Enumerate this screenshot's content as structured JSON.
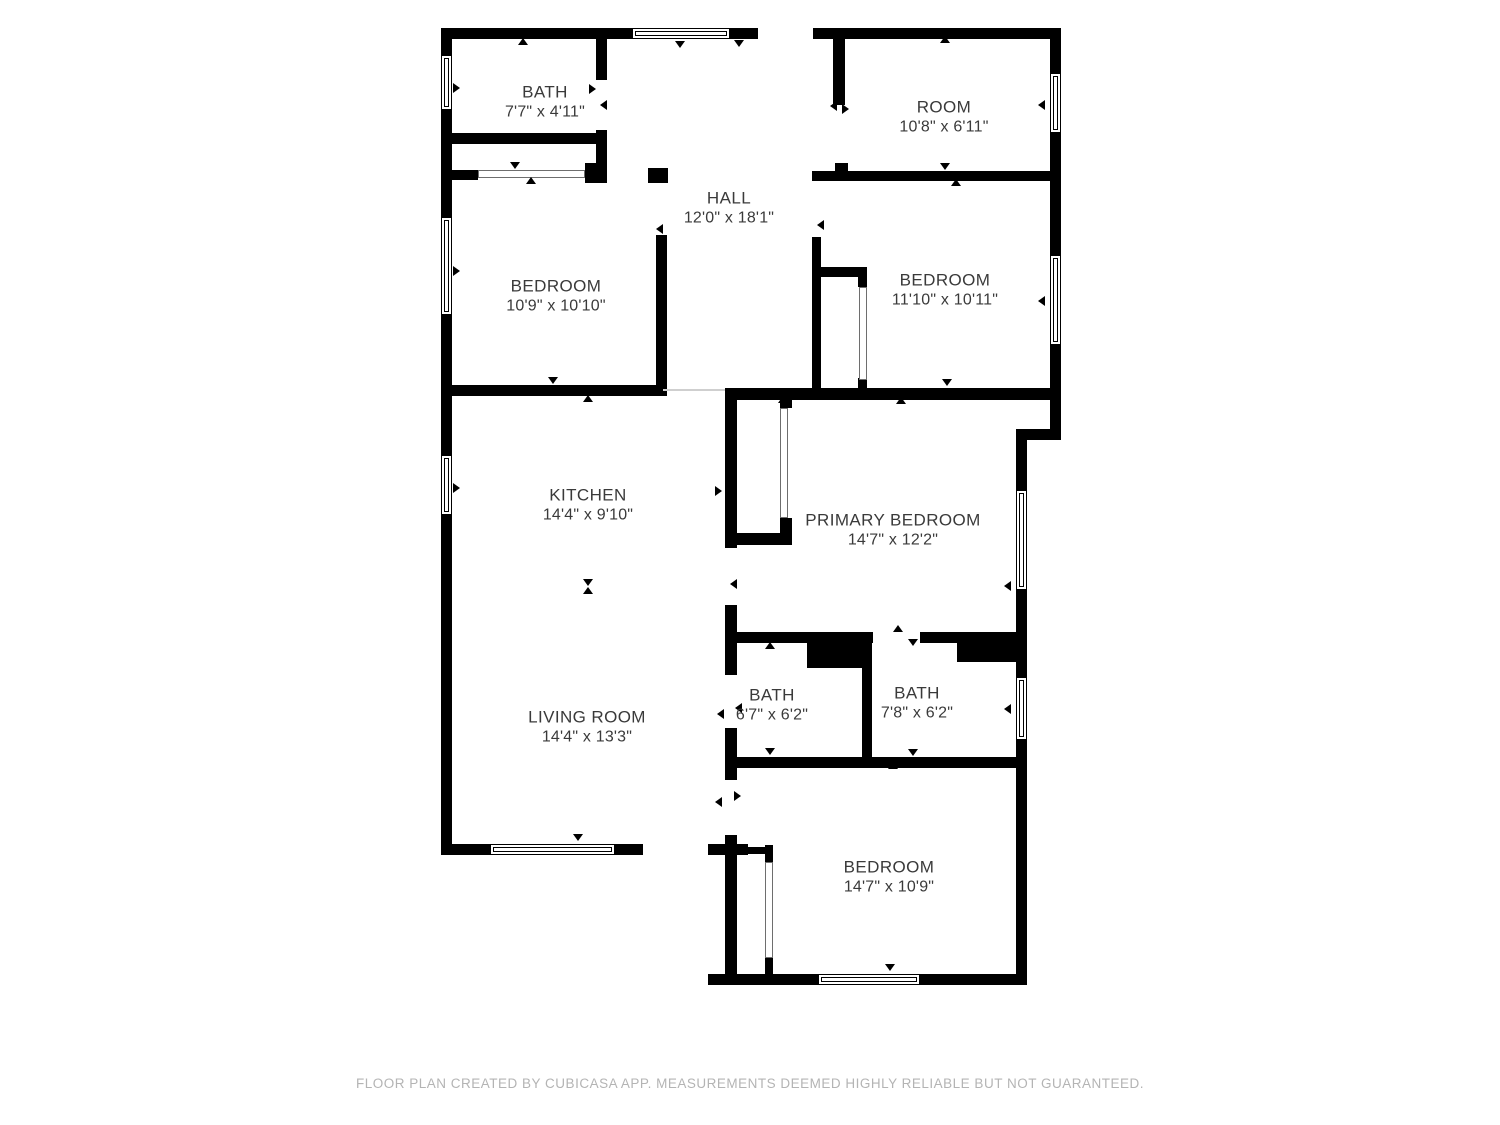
{
  "page": {
    "background": "#ffffff"
  },
  "footer": {
    "text": "FLOOR PLAN CREATED BY CUBICASA APP. MEASUREMENTS DEEMED HIGHLY RELIABLE BUT NOT GUARANTEED."
  },
  "plan": {
    "wall_color": "#000000",
    "label_color": "#3a3a3a",
    "footer_color": "#b4b4b4",
    "rooms": [
      {
        "name": "BATH",
        "dims": "7'7\" x 4'11\"",
        "cx": 545,
        "cy": 102
      },
      {
        "name": "ROOM",
        "dims": "10'8\" x 6'11\"",
        "cx": 944,
        "cy": 117
      },
      {
        "name": "HALL",
        "dims": "12'0\" x 18'1\"",
        "cx": 729,
        "cy": 208
      },
      {
        "name": "BEDROOM",
        "dims": "10'9\" x 10'10\"",
        "cx": 556,
        "cy": 296
      },
      {
        "name": "BEDROOM",
        "dims": "11'10\" x 10'11\"",
        "cx": 945,
        "cy": 290
      },
      {
        "name": "KITCHEN",
        "dims": "14'4\" x 9'10\"",
        "cx": 588,
        "cy": 505
      },
      {
        "name": "PRIMARY BEDROOM",
        "dims": "14'7\" x 12'2\"",
        "cx": 893,
        "cy": 530
      },
      {
        "name": "LIVING ROOM",
        "dims": "14'4\" x 13'3\"",
        "cx": 587,
        "cy": 727
      },
      {
        "name": "BATH",
        "dims": "6'7\" x 6'2\"",
        "cx": 772,
        "cy": 705
      },
      {
        "name": "BATH",
        "dims": "7'8\" x 6'2\"",
        "cx": 917,
        "cy": 703
      },
      {
        "name": "BEDROOM",
        "dims": "14'7\" x 10'9\"",
        "cx": 889,
        "cy": 877
      }
    ],
    "walls": [
      [
        441,
        28,
        191,
        11
      ],
      [
        730,
        28,
        28,
        11
      ],
      [
        813,
        28,
        248,
        11
      ],
      [
        441,
        28,
        11,
        27
      ],
      [
        441,
        110,
        11,
        107
      ],
      [
        441,
        315,
        11,
        140
      ],
      [
        441,
        515,
        11,
        340
      ],
      [
        1050,
        28,
        11,
        45
      ],
      [
        1050,
        133,
        11,
        122
      ],
      [
        1050,
        345,
        11,
        95
      ],
      [
        1016,
        429,
        45,
        11
      ],
      [
        1016,
        440,
        11,
        50
      ],
      [
        1016,
        590,
        11,
        87
      ],
      [
        1016,
        740,
        11,
        234
      ],
      [
        441,
        844,
        49,
        11
      ],
      [
        615,
        844,
        28,
        11
      ],
      [
        708,
        844,
        40,
        11
      ],
      [
        708,
        974,
        110,
        11
      ],
      [
        920,
        974,
        107,
        11
      ],
      [
        441,
        133,
        166,
        11
      ],
      [
        441,
        170,
        37,
        10
      ],
      [
        585,
        163,
        22,
        20
      ],
      [
        648,
        168,
        20,
        15
      ],
      [
        812,
        171,
        249,
        10
      ],
      [
        441,
        385,
        222,
        11
      ],
      [
        725,
        388,
        336,
        12
      ],
      [
        596,
        28,
        11,
        52
      ],
      [
        596,
        130,
        11,
        53
      ],
      [
        656,
        235,
        11,
        161
      ],
      [
        833,
        28,
        12,
        77
      ],
      [
        835,
        163,
        13,
        17
      ],
      [
        812,
        237,
        9,
        159
      ],
      [
        725,
        388,
        12,
        160
      ],
      [
        725,
        605,
        12,
        70
      ],
      [
        725,
        728,
        12,
        52
      ],
      [
        725,
        835,
        12,
        150
      ],
      [
        862,
        640,
        10,
        128
      ],
      [
        733,
        632,
        140,
        11
      ],
      [
        920,
        632,
        37,
        11
      ],
      [
        733,
        757,
        284,
        11
      ],
      [
        807,
        632,
        63,
        36
      ],
      [
        957,
        632,
        60,
        30
      ],
      [
        780,
        395,
        12,
        13
      ],
      [
        780,
        518,
        12,
        27
      ],
      [
        737,
        533,
        55,
        12
      ],
      [
        821,
        267,
        46,
        10
      ],
      [
        858,
        277,
        9,
        10
      ],
      [
        858,
        378,
        9,
        10
      ],
      [
        765,
        845,
        8,
        17
      ],
      [
        765,
        958,
        8,
        16
      ],
      [
        737,
        847,
        30,
        7
      ]
    ],
    "windows": [
      [
        632,
        28,
        98,
        11
      ],
      [
        441,
        55,
        11,
        55
      ],
      [
        441,
        217,
        11,
        98
      ],
      [
        441,
        455,
        11,
        60
      ],
      [
        1050,
        73,
        11,
        60
      ],
      [
        1050,
        255,
        11,
        90
      ],
      [
        1016,
        490,
        11,
        100
      ],
      [
        1016,
        677,
        11,
        63
      ],
      [
        490,
        844,
        125,
        11
      ],
      [
        818,
        974,
        102,
        11
      ]
    ],
    "sliding_doors": [
      [
        478,
        170,
        107,
        8
      ],
      [
        859,
        287,
        8,
        93
      ],
      [
        780,
        408,
        8,
        110
      ],
      [
        765,
        862,
        8,
        96
      ]
    ],
    "dividers": [
      [
        663,
        389,
        62,
        2
      ]
    ],
    "markers": [
      [
        523,
        42,
        "up"
      ],
      [
        680,
        45,
        "down"
      ],
      [
        739,
        44,
        "down"
      ],
      [
        945,
        40,
        "up"
      ],
      [
        458,
        87,
        "right"
      ],
      [
        458,
        270,
        "right"
      ],
      [
        458,
        487,
        "right"
      ],
      [
        1043,
        104,
        "left"
      ],
      [
        1043,
        300,
        "left"
      ],
      [
        1009,
        585,
        "left"
      ],
      [
        1009,
        708,
        "left"
      ],
      [
        578,
        838,
        "down"
      ],
      [
        890,
        968,
        "down"
      ],
      [
        594,
        88,
        "right"
      ],
      [
        605,
        104,
        "left"
      ],
      [
        515,
        166,
        "down"
      ],
      [
        531,
        181,
        "up"
      ],
      [
        661,
        228,
        "left"
      ],
      [
        835,
        105,
        "left"
      ],
      [
        847,
        108,
        "right"
      ],
      [
        822,
        224,
        "left"
      ],
      [
        945,
        167,
        "down"
      ],
      [
        956,
        183,
        "up"
      ],
      [
        553,
        381,
        "down"
      ],
      [
        588,
        399,
        "up"
      ],
      [
        947,
        383,
        "down"
      ],
      [
        783,
        400,
        "up"
      ],
      [
        901,
        401,
        "up"
      ],
      [
        735,
        583,
        "left"
      ],
      [
        720,
        490,
        "right"
      ],
      [
        722,
        713,
        "left"
      ],
      [
        740,
        707,
        "left"
      ],
      [
        770,
        646,
        "up"
      ],
      [
        770,
        752,
        "down"
      ],
      [
        893,
        766,
        "up"
      ],
      [
        913,
        753,
        "down"
      ],
      [
        898,
        629,
        "up"
      ],
      [
        913,
        643,
        "down"
      ],
      [
        720,
        801,
        "left"
      ],
      [
        739,
        795,
        "right"
      ],
      [
        588,
        583,
        "down"
      ],
      [
        588,
        591,
        "up"
      ]
    ]
  }
}
